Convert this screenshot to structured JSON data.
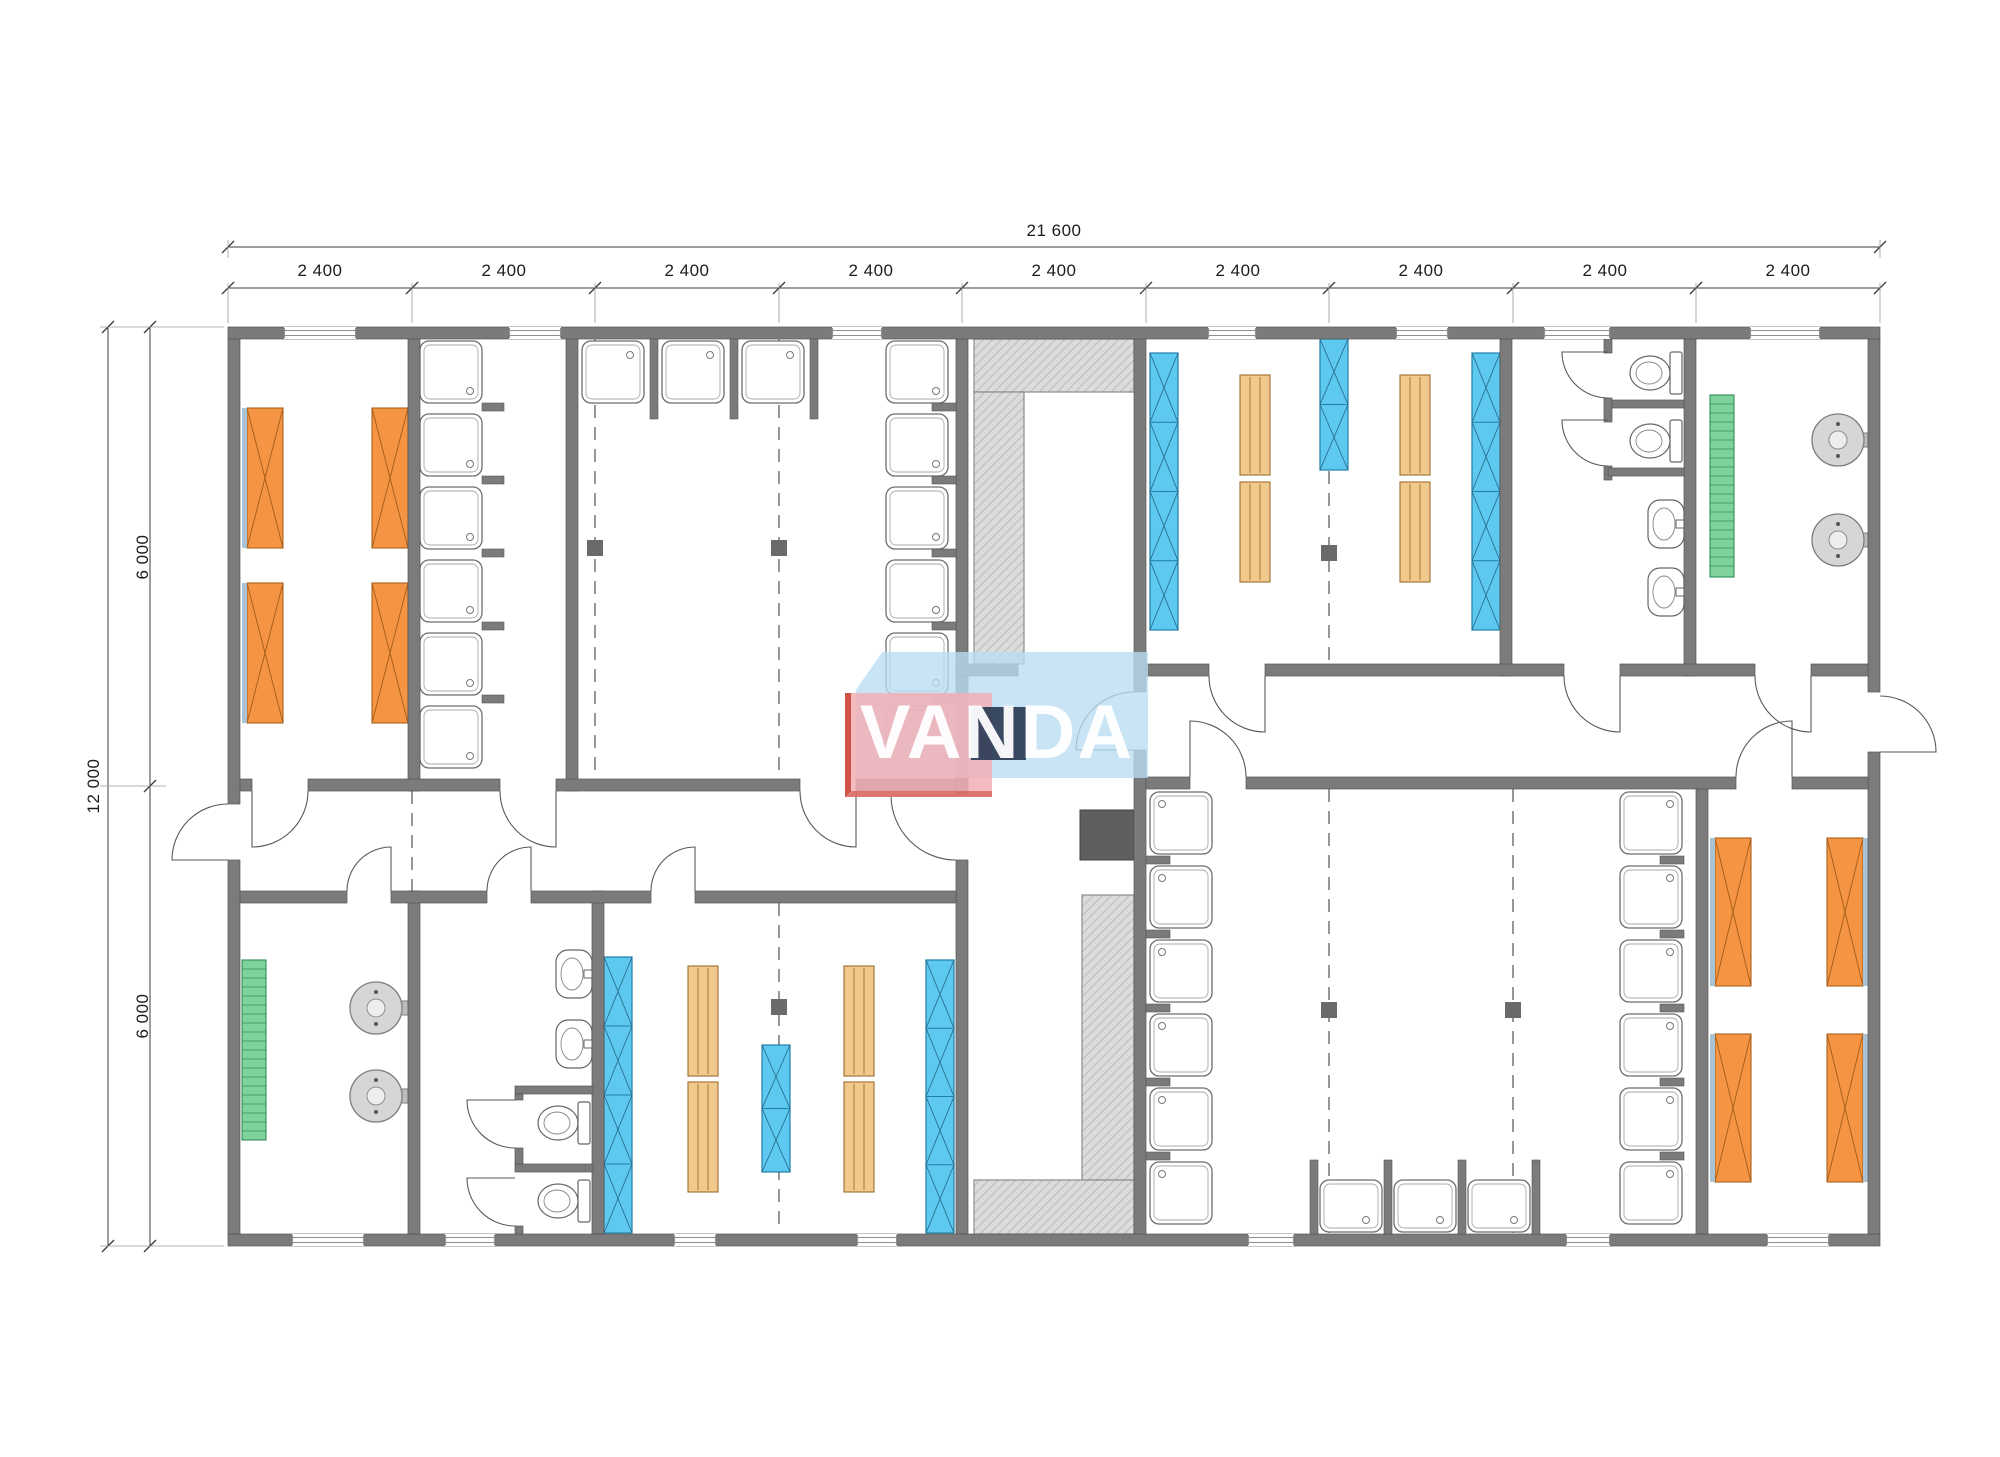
{
  "page": {
    "title": "Modular building floor plan"
  },
  "logo": {
    "text": "VANDA"
  },
  "dimensions": {
    "top_total": "21 600",
    "top_segments": [
      "2 400",
      "2 400",
      "2 400",
      "2 400",
      "2 400",
      "2 400",
      "2 400",
      "2 400",
      "2 400"
    ],
    "left_total": "12 000",
    "left_upper": "6 000",
    "left_lower": "6 000"
  },
  "fixtures": {
    "beds": 8,
    "locker_cabinets": 6,
    "benches": 8,
    "shower_trays": 30,
    "toilets": 4,
    "wash_basins": 4,
    "water_heaters": 4,
    "radiators": 2,
    "hatched_counters": 4,
    "stove": 1,
    "doors": 19,
    "windows": 14
  },
  "colors": {
    "wall": "#7b7b7b",
    "wall_edge": "#565656",
    "bed_orange": "#f59443",
    "bed_edge": "#a8611c",
    "bed_strip": "#a9c2d4",
    "cabinet_blue": "#5ec9f0",
    "cabinet_edge": "#1f7fa8",
    "bench_tan": "#f2c98c",
    "bench_edge": "#9a6d2c",
    "radiator_green": "#80d29d",
    "radiator_edge": "#2f8f55",
    "hatch_bg": "#dcdcdc",
    "hatch_line": "#c3c3c3",
    "hatch_edge": "#8c8c8c",
    "fixture_line": "#6e6e6e",
    "stove_dark": "#5f5f5f",
    "module_square": "#6a6a6a",
    "dim_line": "#3c3c3c",
    "ext_line": "#9a9a9a"
  }
}
